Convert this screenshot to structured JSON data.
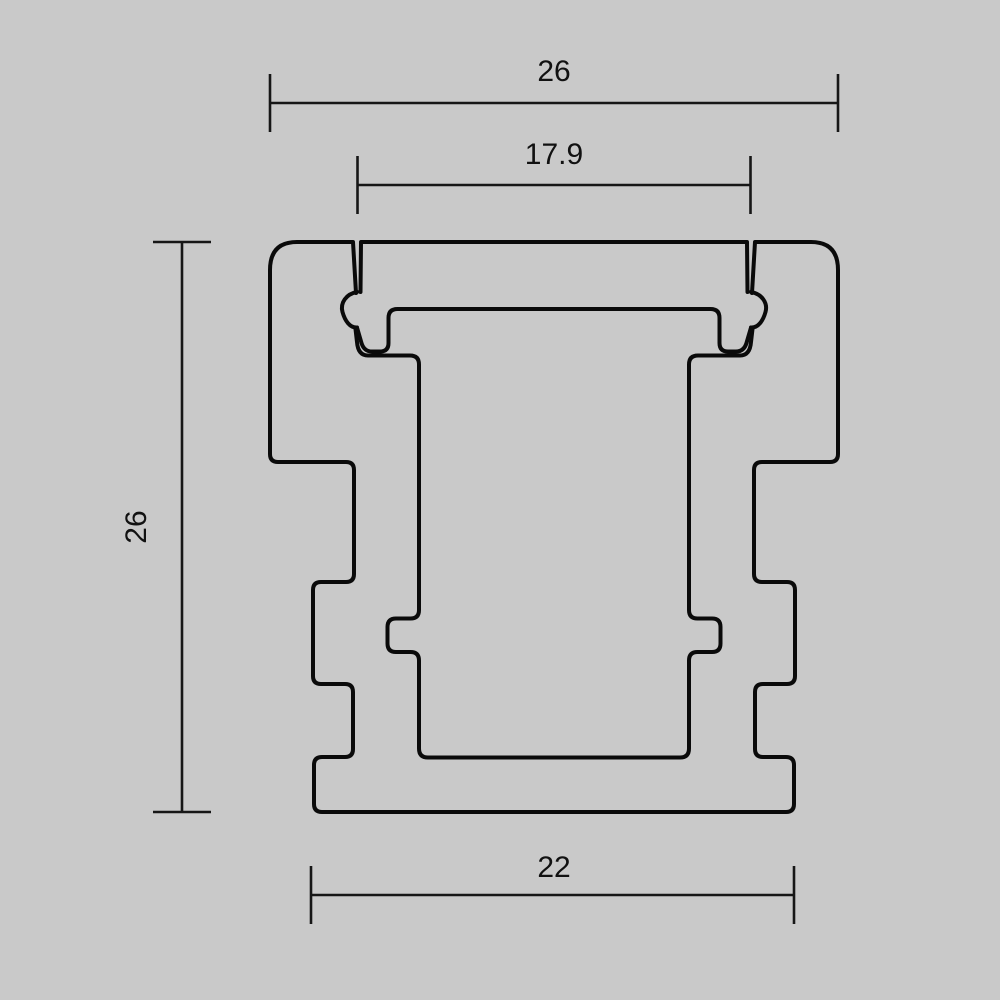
{
  "drawing": {
    "type": "technical-cross-section",
    "subject": "aluminium-led-profile",
    "dimensions": {
      "outer_width": "26",
      "opening_width": "17.9",
      "height": "26",
      "base_width": "22"
    },
    "colors": {
      "background": "#c9c9c9",
      "outline": "#0a0a0a",
      "dimension_lines": "#161616"
    }
  }
}
